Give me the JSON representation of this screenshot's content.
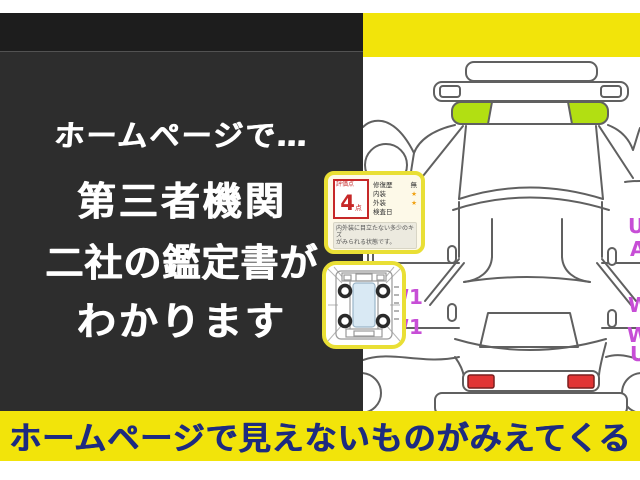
{
  "headline_panel": {
    "lines": [
      "ホームページで…",
      "第三者機関",
      "二社の鑑定書が",
      "わかります"
    ]
  },
  "bottom_banner": {
    "text": "ホームページで見えないものがみえてくる"
  },
  "score_card": {
    "score_label": "評価点",
    "score_value": "4",
    "score_unit": "点",
    "rows": [
      {
        "label": "修復歴",
        "value": "無"
      },
      {
        "label": "内装",
        "value": "★"
      },
      {
        "label": "外装",
        "value": "★"
      },
      {
        "label": "検査日",
        "value": ""
      }
    ],
    "note_line1": "内外装に目立たない多少のキズ",
    "note_line2": "がみられる状態です。"
  },
  "diagram": {
    "left_marks": [
      "W1",
      "W1"
    ],
    "right_marks": [
      "U",
      "A",
      "W",
      "W",
      "U"
    ]
  },
  "colors": {
    "banner_yellow": "#f2e40a",
    "banner_text_navy": "#1d2b80",
    "panel_black": "#2d2d2d",
    "highlight_green": "#b2df12",
    "mark_magenta": "#c74ed6",
    "tail_light_red": "#e13434",
    "score_red": "#c62828",
    "card_border_yellow": "#e9df35"
  }
}
